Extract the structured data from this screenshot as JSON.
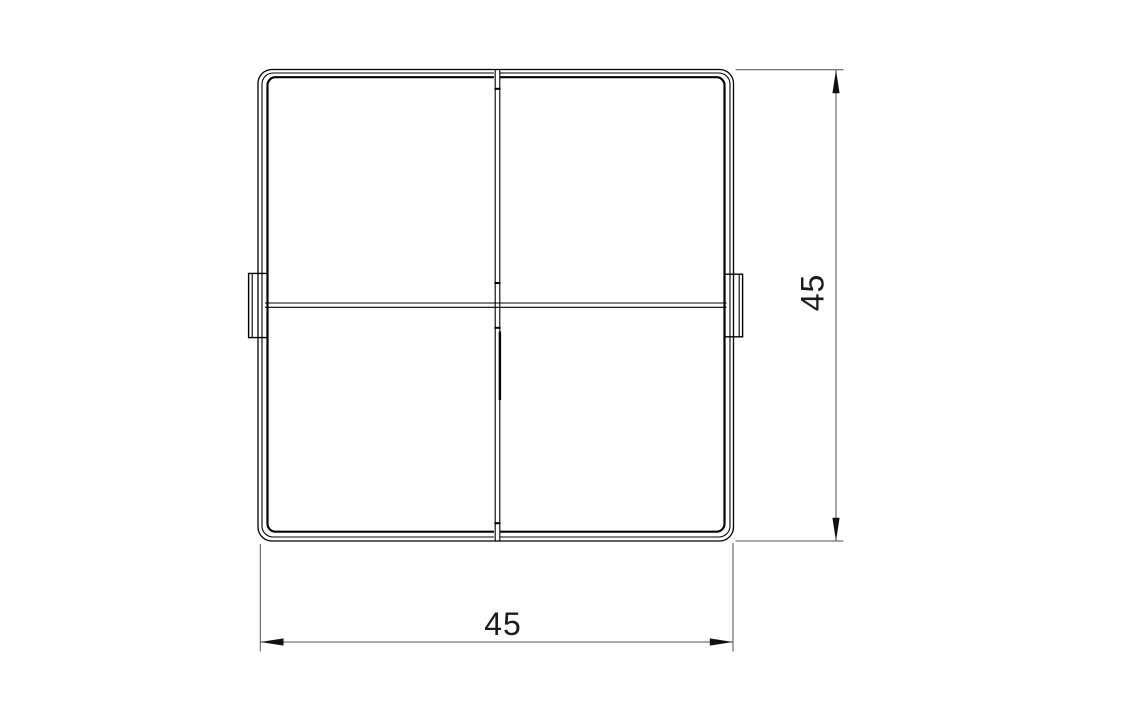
{
  "drawing": {
    "colors": {
      "background": "#ffffff",
      "part-line": "#000000",
      "dim-line": "#4f4f4f",
      "arrow": "#101010",
      "dim-text": "#1c1c1c"
    },
    "dimensions": {
      "width": {
        "label": "45"
      },
      "height": {
        "label": "45"
      }
    }
  }
}
